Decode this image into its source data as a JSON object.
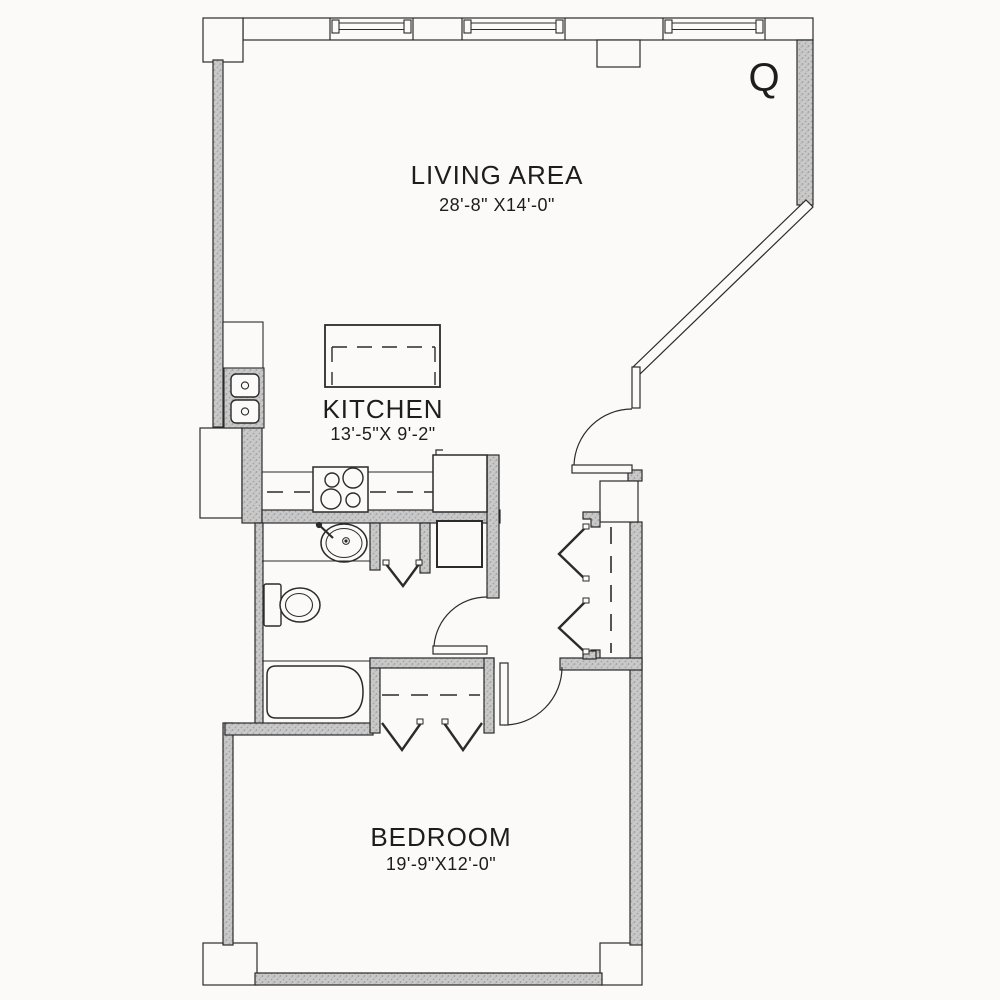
{
  "floor_plan": {
    "unit_label": "Q",
    "rooms": [
      {
        "name": "LIVING AREA",
        "dimensions": "28'-8\" X14'-0\""
      },
      {
        "name": "KITCHEN",
        "dimensions": "13'-5\"X 9'-2\""
      },
      {
        "name": "BEDROOM",
        "dimensions": "19'-9\"X12'-0\""
      }
    ],
    "colors": {
      "wall_fill": "#c9c9c9",
      "line": "#2b2b2b",
      "background": "#fbfaf8"
    },
    "fixtures": [
      "kitchen-island",
      "range-stove",
      "refrigerator",
      "double-basin-sink",
      "bathroom-sink",
      "toilet",
      "bathtub",
      "shower-unit",
      "entry-door",
      "bathroom-door",
      "bedroom-door",
      "closet-bifold-doors",
      "windows"
    ]
  }
}
